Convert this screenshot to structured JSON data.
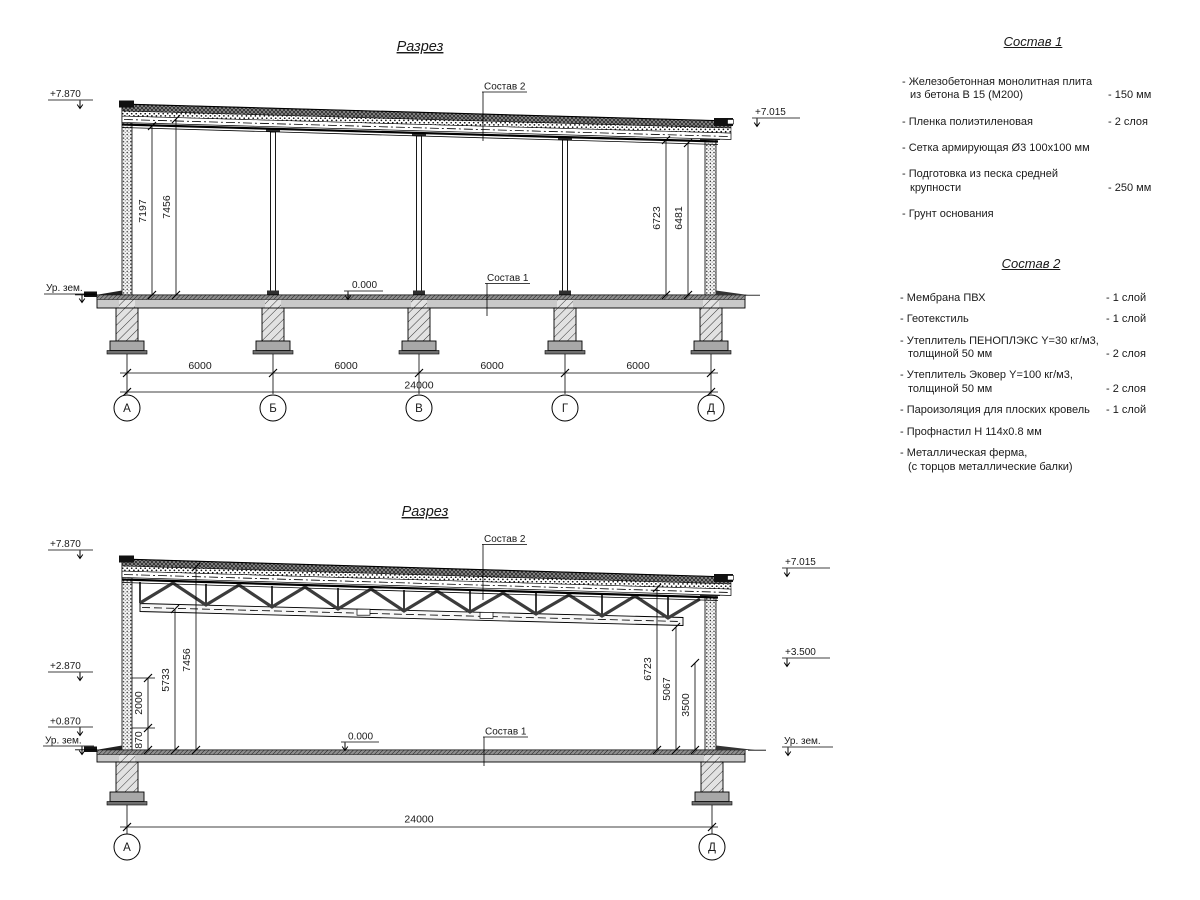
{
  "s1": {
    "title": "Разрез",
    "elev_left": "+7.870",
    "elev_right": "+7.015",
    "ground_left": "Ур. зем.",
    "zero": "0.000",
    "label_roof": "Состав 2",
    "label_floor": "Состав 1",
    "vdims": [
      "7197",
      "7456",
      "6723",
      "6481"
    ],
    "hdims": [
      "6000",
      "6000",
      "6000",
      "6000"
    ],
    "total": "24000",
    "axes": [
      "А",
      "Б",
      "В",
      "Г",
      "Д"
    ]
  },
  "s2": {
    "title": "Разрез",
    "elev_left_top": "+7.870",
    "elev_left_mid": "+2.870",
    "elev_left_low": "+0.870",
    "ground_left": "Ур. зем.",
    "ground_right": "Ур. зем.",
    "elev_right_top": "+7.015",
    "elev_right_mid": "+3.500",
    "zero": "0.000",
    "label_roof": "Состав 2",
    "label_floor": "Состав 1",
    "vdims_left": [
      "870",
      "2000",
      "5733",
      "7456"
    ],
    "vdims_right": [
      "6723",
      "5067",
      "3500"
    ],
    "total": "24000",
    "axes": [
      "А",
      "Д"
    ]
  },
  "spec1": {
    "title": "Состав 1",
    "items": [
      {
        "name": "- Железобетонная  монолитная плита\nиз бетона В 15 (М200)",
        "value": "- 150 мм"
      },
      {
        "name": "- Пленка полиэтиленовая",
        "value": "- 2 слоя"
      },
      {
        "name": "- Сетка армирующая Ø3 100х100 мм",
        "value": ""
      },
      {
        "name": "- Подготовка из песка средней\nкрупности",
        "value": "- 250 мм"
      },
      {
        "name": "- Грунт основания",
        "value": ""
      }
    ]
  },
  "spec2": {
    "title": "Состав 2",
    "items": [
      {
        "name": "- Мембрана ПВХ",
        "value": "- 1 слой"
      },
      {
        "name": "- Геотекстиль",
        "value": "- 1 слой"
      },
      {
        "name": "- Утеплитель ПЕНОПЛЭКС Y=30 кг/м3,\nтолщиной 50 мм",
        "value": "- 2 слоя"
      },
      {
        "name": "- Утеплитель Эковер Y=100 кг/м3,\nтолщиной 50 мм",
        "value": "- 2 слоя"
      },
      {
        "name": "- Пароизоляция для плоских кровель",
        "value": "- 1 слой"
      },
      {
        "name": "- Профнастил Н 114х0.8 мм",
        "value": ""
      },
      {
        "name": "- Металлическая ферма,\n(с торцов металлические балки)",
        "value": ""
      }
    ]
  }
}
